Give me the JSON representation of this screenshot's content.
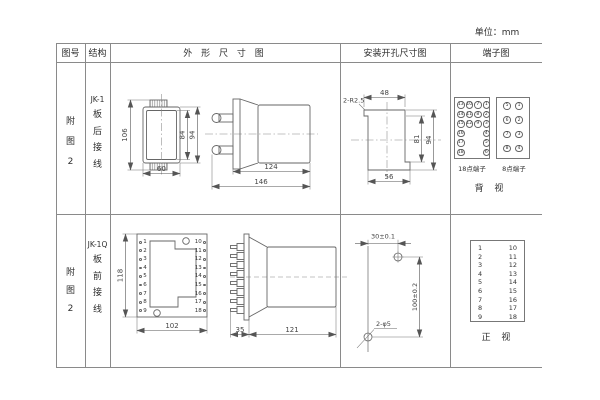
{
  "unit_label": "单位：mm",
  "headers": {
    "col1": "图号",
    "col2": "结构",
    "col3": "外 形 尺 寸 图",
    "col4": "安装开孔尺寸图",
    "col5": "端子图"
  },
  "row1": {
    "figure_no": "附图2",
    "structure_model": "JK-1",
    "structure_type": "板后接线",
    "outline_dims": {
      "height_total": "106",
      "height_inner": "84",
      "height_outer": "94",
      "width": "60",
      "depth_body": "124",
      "depth_total": "146"
    },
    "mounting_dims": {
      "corner_radius": "2-R2.5",
      "top_width": "48",
      "height_inner": "81",
      "height_total": "94",
      "bottom_width": "56"
    },
    "terminal": {
      "block18_label": "18点端子",
      "block8_label": "8点端子",
      "view_label": "背 视",
      "block18_cells": [
        "13",
        "10",
        "7",
        "1",
        "14",
        "11",
        "8",
        "2",
        "15",
        "12",
        "9",
        "3",
        "16",
        "",
        "",
        "4",
        "17",
        "",
        "",
        "5",
        "18",
        "",
        "",
        "6"
      ],
      "block8_cells": [
        "5",
        "1",
        "6",
        "2",
        "7",
        "3",
        "8",
        "4"
      ]
    }
  },
  "row2": {
    "figure_no": "附图2",
    "structure_model": "JK-1Q",
    "structure_type": "板前接线",
    "outline_dims": {
      "height": "118",
      "width": "102",
      "depth_flange": "35",
      "depth_body": "121"
    },
    "front_terminals_left": [
      "1",
      "2",
      "3",
      "4",
      "5",
      "6",
      "7",
      "8",
      "9"
    ],
    "front_terminals_right": [
      "10",
      "11",
      "12",
      "13",
      "14",
      "15",
      "16",
      "17",
      "18"
    ],
    "mounting_dims": {
      "hole_spacing_h": "30±0.1",
      "hole_spacing_v": "100±0.2",
      "hole_label": "2-φ5"
    },
    "terminal": {
      "left_col": [
        "1",
        "2",
        "3",
        "4",
        "5",
        "6",
        "7",
        "8",
        "9"
      ],
      "right_col": [
        "10",
        "11",
        "12",
        "13",
        "14",
        "15",
        "16",
        "17",
        "18"
      ],
      "view_label": "正 视"
    }
  }
}
